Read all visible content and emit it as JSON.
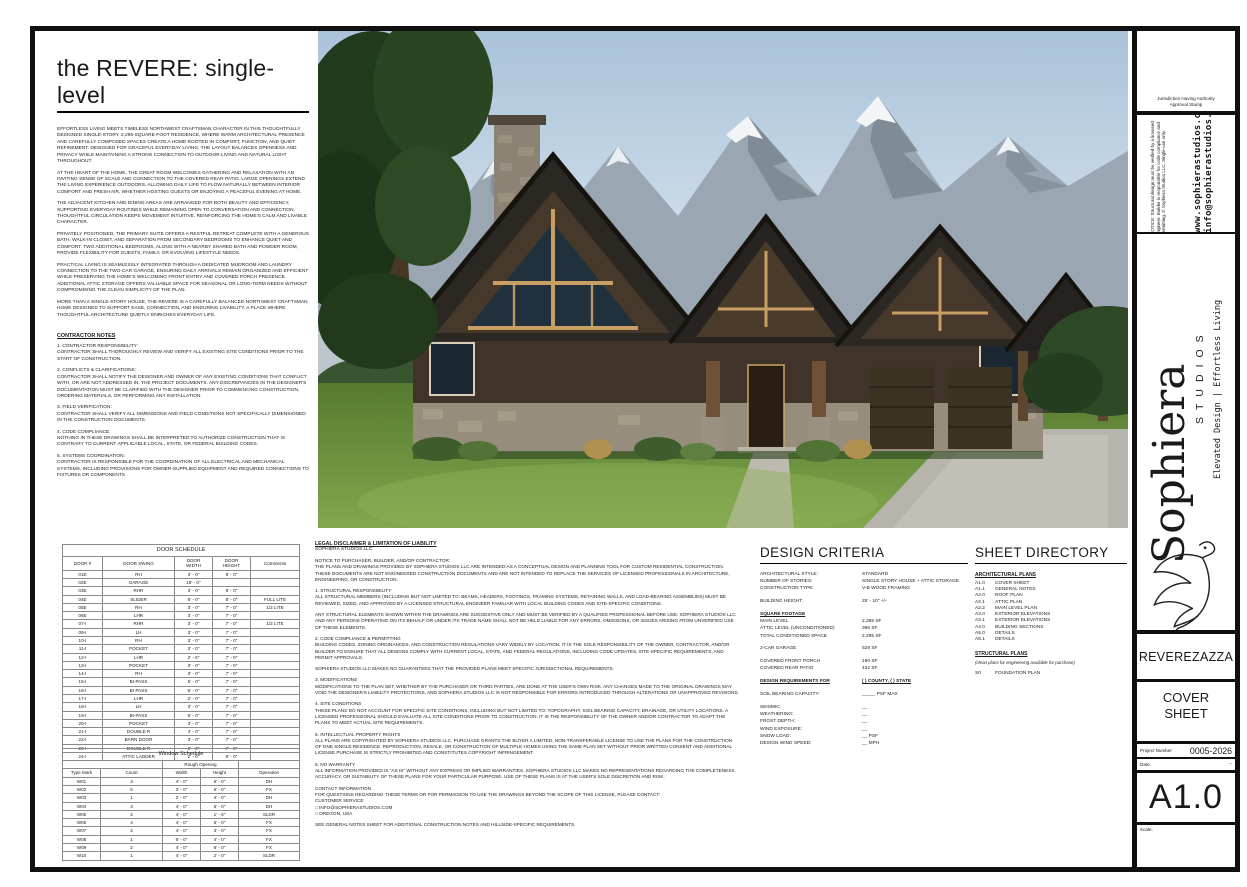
{
  "sheet": {
    "title": "the REVERE: single-level",
    "intro_paragraphs": [
      "EFFORTLESS LIVING MEETS TIMELESS NORTHWEST CRAFTSMAN CHARACTER IN THIS THOUGHTFULLY DESIGNED SINGLE-STORY, 2,295-SQUARE-FOOT RESIDENCE, WHERE WARM ARCHITECTURAL PRESENCE AND CAREFULLY COMPOSED SPACES CREATE A HOME ROOTED IN COMFORT, FUNCTION, AND QUIET REFINEMENT. DESIGNED FOR GRACEFUL EVERYDAY LIVING, THE LAYOUT BALANCES OPENNESS AND PRIVACY WHILE MAINTAINING A STRONG CONNECTION TO OUTDOOR LIVING AND NATURAL LIGHT THROUGHOUT.",
      "AT THE HEART OF THE HOME, THE GREAT ROOM WELCOMES GATHERING AND RELAXATION WITH AN INVITING SENSE OF SCALE AND CONNECTION TO THE COVERED REAR PATIO. LARGE OPENINGS EXTEND THE LIVING EXPERIENCE OUTDOORS, ALLOWING DAILY LIFE TO FLOW NATURALLY BETWEEN INTERIOR COMFORT AND FRESH AIR, WHETHER HOSTING GUESTS OR ENJOYING A PEACEFUL EVENING AT HOME.",
      "THE ADJACENT KITCHEN AND DINING AREAS ARE ARRANGED FOR BOTH BEAUTY AND EFFICIENCY, SUPPORTING EVERYDAY ROUTINES WHILE REMAINING OPEN TO CONVERSATION AND CONNECTION. THOUGHTFUL CIRCULATION KEEPS MOVEMENT INTUITIVE, REINFORCING THE HOME'S CALM AND LIVABLE CHARACTER.",
      "PRIVATELY POSITIONED, THE PRIMARY SUITE OFFERS A RESTFUL RETREAT COMPLETE WITH A GENEROUS BATH, WALK-IN CLOSET, AND SEPARATION FROM SECONDARY BEDROOMS TO ENHANCE QUIET AND COMFORT. TWO ADDITIONAL BEDROOMS, ALONG WITH A NEARBY SHARED BATH AND POWDER ROOM, PROVIDE FLEXIBILITY FOR GUESTS, FAMILY, OR EVOLVING LIFESTYLE NEEDS.",
      "PRACTICAL LIVING IS SEAMLESSLY INTEGRATED THROUGH A DEDICATED MUDROOM AND LAUNDRY CONNECTION TO THE TWO-CAR GARAGE, ENSURING DAILY ARRIVALS REMAIN ORGANIZED AND EFFICIENT WHILE PRESERVING THE HOME'S WELCOMING FRONT ENTRY AND COVERED PORCH PRESENCE. ADDITIONAL ATTIC STORAGE OFFERS VALUABLE SPACE FOR SEASONAL OR LONG-TERM NEEDS WITHOUT COMPROMISING THE CLEAN SIMPLICITY OF THE PLAN.",
      "MORE THAN A SINGLE-STORY HOUSE, THE REVERE IS A CAREFULLY BALANCED NORTHWEST CRAFTSMAN HOME DESIGNED TO SUPPORT EASE, CONNECTION, AND ENDURING LIVABILITY, A PLACE WHERE THOUGHTFUL ARCHITECTURE QUIETLY ENRICHES EVERYDAY LIFE."
    ],
    "contractor_notes": {
      "heading": "CONTRACTOR NOTES",
      "items": [
        "1. CONTRACTOR RESPONSIBILITY:\n CONTRACTOR SHALL THOROUGHLY REVIEW AND VERIFY ALL EXISTING SITE CONDITIONS PRIOR TO THE START OF CONSTRUCTION.",
        "2. CONFLICTS & CLARIFICATIONS:\n CONTRACTOR SHALL NOTIFY THE DESIGNER AND OWNER OF ANY EXISTING CONDITIONS THAT CONFLICT WITH, OR ARE NOT ADDRESSED IN, THE PROJECT DOCUMENTS. ANY DISCREPANCIES IN THE DESIGNER'S DOCUMENTATION MUST BE CLARIFIED WITH THE DESIGNER PRIOR TO COMMENCING CONSTRUCTION, ORDERING MATERIALS, OR PERFORMING ANY INSTALLATION.",
        "3. FIELD VERIFICATION:\n CONTRACTOR SHALL VERIFY ALL DIMENSIONS AND FIELD CONDITIONS NOT SPECIFICALLY DIMENSIONED IN THE CONSTRUCTION DOCUMENTS.",
        "4. CODE COMPLIANCE:\n NOTHING IN THESE DRAWINGS SHALL BE INTERPRETED TO AUTHORIZE CONSTRUCTION THAT IS CONTRARY TO CURRENT APPLICABLE LOCAL, STATE, OR FEDERAL BUILDING CODES.",
        "5. SYSTEMS COORDINATION:\n CONTRACTOR IS RESPONSIBLE FOR THE COORDINATION OF ALL ELECTRICAL AND MECHANICAL SYSTEMS, INCLUDING PROVISIONS FOR OWNER-SUPPLIED EQUIPMENT AND REQUIRED CONNECTIONS TO FIXTURES OR COMPONENTS."
      ]
    }
  },
  "door_schedule": {
    "title": "DOOR SCHEDULE",
    "columns": [
      "DOOR #",
      "DOOR SWING",
      "DOOR\nWIDTH",
      "DOOR\nHEIGHT",
      "Comments"
    ],
    "rows": [
      [
        "01E",
        "RH",
        "3' - 0\"",
        "8' - 0\"",
        ""
      ],
      [
        "02E",
        "GARAGE",
        "18' - 0\"",
        "",
        ""
      ],
      [
        "03E",
        "RHR",
        "3' - 0\"",
        "8' - 0\"",
        ""
      ],
      [
        "04E",
        "SLIDER",
        "8' - 0\"",
        "8' - 0\"",
        "FULL LITE"
      ],
      [
        "05E",
        "RH",
        "3' - 0\"",
        "7' - 0\"",
        "1/2 LITE"
      ],
      [
        "06E",
        "LHR",
        "3' - 0\"",
        "7' - 0\"",
        ""
      ],
      [
        "07-I",
        "RHR",
        "3' - 0\"",
        "7' - 0\"",
        "1/2 LITE"
      ],
      [
        "09-I",
        "LH",
        "3' - 0\"",
        "7' - 0\"",
        ""
      ],
      [
        "10-I",
        "RH",
        "3' - 0\"",
        "7' - 0\"",
        ""
      ],
      [
        "11-I",
        "POCKET",
        "3' - 0\"",
        "7' - 0\"",
        ""
      ],
      [
        "12-I",
        "LHR",
        "2' - 6\"",
        "7' - 0\"",
        ""
      ],
      [
        "13-I",
        "POCKET",
        "3' - 0\"",
        "7' - 0\"",
        ""
      ],
      [
        "14-I",
        "RH",
        "3' - 0\"",
        "7' - 0\"",
        ""
      ],
      [
        "15-I",
        "BI-PASS",
        "5' - 0\"",
        "7' - 0\"",
        ""
      ],
      [
        "16-I",
        "BI-PASS",
        "6' - 0\"",
        "7' - 0\"",
        ""
      ],
      [
        "17-I",
        "LHR",
        "2' - 0\"",
        "7' - 0\"",
        ""
      ],
      [
        "18-I",
        "LH",
        "3' - 0\"",
        "7' - 0\"",
        ""
      ],
      [
        "19-I",
        "BI-PASS",
        "5' - 0\"",
        "7' - 0\"",
        ""
      ],
      [
        "20-I",
        "POCKET",
        "3' - 0\"",
        "7' - 0\"",
        ""
      ],
      [
        "21-I",
        "DOUBLE R",
        "4' - 0\"",
        "7' - 0\"",
        ""
      ],
      [
        "22-I",
        "BARN DOOR",
        "3' - 0\"",
        "7' - 0\"",
        ""
      ],
      [
        "23-I",
        "DOUBLE R",
        "5' - 0\"",
        "7' - 0\"",
        ""
      ],
      [
        "24-I",
        "ATTIC LADDER",
        "2' - 0\"",
        "9' - 0\"",
        ""
      ]
    ]
  },
  "window_schedule": {
    "title": "Window Schedule",
    "group_header": "Rough Opening",
    "columns": [
      "Type Mark",
      "Count",
      "Width",
      "Height",
      "Operation"
    ],
    "rows": [
      [
        "W01",
        "3",
        "4' - 0\"",
        "5' - 0\"",
        "DH"
      ],
      [
        "W02",
        "5",
        "3' - 0\"",
        "5' - 0\"",
        "FX"
      ],
      [
        "W03",
        "1",
        "2' - 0\"",
        "4' - 0\"",
        "DH"
      ],
      [
        "W04",
        "3",
        "4' - 0\"",
        "6' - 0\"",
        "DH"
      ],
      [
        "W05",
        "2",
        "4' - 0\"",
        "1' - 6\"",
        "SLDR"
      ],
      [
        "W06",
        "4",
        "4' - 0\"",
        "6' - 0\"",
        "FX"
      ],
      [
        "W07",
        "2",
        "4' - 0\"",
        "3' - 0\"",
        "FX"
      ],
      [
        "W08",
        "1",
        "6' - 0\"",
        "4' - 0\"",
        "FX"
      ],
      [
        "W09",
        "2",
        "4' - 0\"",
        "6' - 0\"",
        "FX"
      ],
      [
        "W10",
        "1",
        "4' - 0\"",
        "2' - 0\"",
        "SLDR"
      ]
    ]
  },
  "legal": {
    "heading": "LEGAL DISCLAIMER & LIMITATION OF LIABILITY",
    "subheading": "SOPHIERA STUDIOS LLC",
    "paragraphs": [
      "NOTICE TO PURCHASER, BUILDER, AND/OR CONTRACTOR:\nTHE PLANS AND DRAWINGS PROVIDED BY SOPHIERA STUDIOS LLC ARE INTENDED AS A CONCEPTUAL DESIGN AND PLANNING TOOL FOR CUSTOM RESIDENTIAL CONSTRUCTION. THESE DOCUMENTS ARE NOT ENGINEERED CONSTRUCTION DOCUMENTS AND ARE NOT INTENDED TO REPLACE THE SERVICES OF LICENSED PROFESSIONALS IN ARCHITECTURE, ENGINEERING, OR CONSTRUCTION.",
      "1. STRUCTURAL RESPONSIBILITY\nALL STRUCTURAL MEMBERS (INCLUDING BUT NOT LIMITED TO: BEAMS, HEADERS, FOOTINGS, FRAMING SYSTEMS, RETAINING WALLS, AND LOAD-BEARING ASSEMBLIES) MUST BE REVIEWED, SIZED, AND APPROVED BY A LICENSED STRUCTURAL ENGINEER FAMILIAR WITH LOCAL BUILDING CODES AND SITE-SPECIFIC CONDITIONS.",
      "ANY STRUCTURAL ELEMENTS SHOWN WITHIN THE DRAWINGS ARE SUGGESTIVE ONLY AND MUST BE VERIFIED BY A QUALIFIED PROFESSIONAL BEFORE USE. SOPHIERA STUDIOS LLC AND ANY PERSONS OPERATING ON ITS BEHALF OR UNDER ITS TRADE NAME SHALL NOT BE HELD LIABLE FOR ANY ERRORS, OMISSIONS, OR ISSUES ARISING FROM UNVERIFIED USE OF THESE ELEMENTS.",
      "2. CODE COMPLIANCE & PERMITTING\nBUILDING CODES, ZONING ORDINANCES, AND CONSTRUCTION REGULATIONS VARY WIDELY BY LOCATION. IT IS THE SOLE RESPONSIBILITY OF THE OWNER, CONTRACTOR, AND/OR BUILDER TO ENSURE THAT ALL DESIGNS COMPLY WITH CURRENT LOCAL, STATE, AND FEDERAL REGULATIONS, INCLUDING CODE UPDATES, SITE-SPECIFIC REQUIREMENTS, AND PERMIT APPROVALS.",
      "SOPHIERA STUDIOS LLC MAKES NO GUARANTEES THAT THE PROVIDED PLANS MEET SPECIFIC JURISDICTIONAL REQUIREMENTS.",
      "3. MODIFICATIONS\nMODIFICATIONS TO THE PLAN SET, WHETHER BY THE PURCHASER OR THIRD PARTIES, ARE DONE AT THE USER'S OWN RISK. ANY CHANGES MADE TO THE ORIGINAL DRAWINGS MAY VOID THE DESIGNER'S LIABILITY PROTECTIONS, AND SOPHIERA STUDIOS LLC IS NOT RESPONSIBLE FOR ERRORS INTRODUCED THROUGH ALTERATIONS OR UNAPPROVED REVISIONS.",
      "4. SITE CONDITIONS\nTHESE PLANS DO NOT ACCOUNT FOR SPECIFIC SITE CONDITIONS, INCLUDING BUT NOT LIMITED TO: TOPOGRAPHY, SOIL BEARING CAPACITY, DRAINAGE, OR UTILITY LOCATIONS. A LICENSED PROFESSIONAL SHOULD EVALUATE ALL SITE CONDITIONS PRIOR TO CONSTRUCTION. IT IS THE RESPONSIBILITY OF THE OWNER AND/OR CONTRACTOR TO ADAPT THE PLANS TO MEET ACTUAL SITE REQUIREMENTS.",
      "5. INTELLECTUAL PROPERTY RIGHTS\nALL PLANS ARE COPYRIGHTED BY SOPHIERA STUDIOS LLC. PURCHASE GRANTS THE BUYER A LIMITED, NON-TRANSFERABLE LICENSE TO USE THE PLANS FOR THE CONSTRUCTION OF ONE SINGLE RESIDENCE. REPRODUCTION, RESALE, OR CONSTRUCTION OF MULTIPLE HOMES USING THE SAME PLAN SET WITHOUT PRIOR WRITTEN CONSENT AND ADDITIONAL LICENSE PURCHASE IS STRICTLY PROHIBITED AND CONSTITUTES COPYRIGHT INFRINGEMENT.",
      "6. NO WARRANTY\nALL INFORMATION PROVIDED IS \"AS IS\" WITHOUT ANY EXPRESS OR IMPLIED WARRANTIES. SOPHIERA STUDIOS LLC MAKES NO REPRESENTATIONS REGARDING THE COMPLETENESS, ACCURACY, OR SUITABILITY OF THESE PLANS FOR YOUR PARTICULAR PURPOSE. USE OF THESE PLANS IS AT THE USER'S SOLE DISCRETION AND RISK.",
      "CONTACT INFORMATION\nFOR QUESTIONS REGARDING THESE TERMS OR FOR PERMISSION TO USE THE DRAWINGS BEYOND THE SCOPE OF THIS LICENSE, PLEASE CONTACT:\nCUSTOMER SERVICE\n□ INFO@SOPHIERASTUDIOS.COM\n□ OREGON, USA",
      "SEE GENERAL NOTES SHEET FOR ADDITIONAL CONSTRUCTION NOTES AND HILLSIDE-SPECIFIC REQUIREMENTS."
    ]
  },
  "design_criteria": {
    "title": "DESIGN CRITERIA",
    "rows": [
      {
        "label": "ARCHITECTURAL STYLE:",
        "value": "STANDARD",
        "style": ""
      },
      {
        "label": "NUMBER OF STORIES:",
        "value": "SINGLE STORY HOUSE + ATTIC STORAGE",
        "style": ""
      },
      {
        "label": "CONSTRUCTION TYPE:",
        "value": "V-B WOOD FRAMING",
        "style": ""
      },
      {
        "label": "",
        "value": "",
        "style": "gap"
      },
      {
        "label": "BUILDING HEIGHT:",
        "value": "25' - 10\" +/-",
        "style": ""
      },
      {
        "label": "",
        "value": "",
        "style": "gap"
      },
      {
        "label": "SQUARE FOOTAGE",
        "value": "",
        "style": "head"
      },
      {
        "label": "MAIN LEVEL",
        "value": "2,295 SF",
        "style": ""
      },
      {
        "label": "ATTIC LEVEL (UNCONDITIONED)",
        "value": "395 SF",
        "style": ""
      },
      {
        "label": "TOTAL CONDITIONED SPACE",
        "value": "2,295 SF",
        "style": ""
      },
      {
        "label": "",
        "value": "",
        "style": "gap"
      },
      {
        "label": "2-CAR GARAGE",
        "value": "528 SF",
        "style": ""
      },
      {
        "label": "",
        "value": "",
        "style": "gap"
      },
      {
        "label": "COVERED FRONT PORCH",
        "value": "190 SF",
        "style": ""
      },
      {
        "label": "COVERED REAR PATIO",
        "value": "432 SF",
        "style": ""
      },
      {
        "label": "",
        "value": "",
        "style": "gap"
      },
      {
        "label": "DESIGN REQUIREMENTS FOR",
        "value": "(   ) COUNTY, (   ) STATE",
        "style": "head"
      },
      {
        "label": "",
        "value": "",
        "style": "gap"
      },
      {
        "label": "SOIL BEARING CAPACITY:",
        "value": "_____ PSF MAX",
        "style": ""
      },
      {
        "label": "",
        "value": "",
        "style": "gap"
      },
      {
        "label": "SEISMIC:",
        "value": "__",
        "style": ""
      },
      {
        "label": "WEATHERING:",
        "value": "__",
        "style": ""
      },
      {
        "label": "FROST DEPTH:",
        "value": "__",
        "style": ""
      },
      {
        "label": "WIND EXPOSURE:",
        "value": "__",
        "style": ""
      },
      {
        "label": "SNOW LOAD:",
        "value": "__ PSF",
        "style": ""
      },
      {
        "label": "DESIGN WIND SPEED:",
        "value": "__ MPH",
        "style": ""
      }
    ]
  },
  "sheet_directory": {
    "title": "SHEET DIRECTORY",
    "arch_heading": "ARCHITECTURAL PLANS",
    "arch_items": [
      {
        "code": "A1.0",
        "label": "COVER SHEET"
      },
      {
        "code": "A1.1",
        "label": "GENERAL NOTES"
      },
      {
        "code": "A2.0",
        "label": "ROOF PLAN"
      },
      {
        "code": "A2.1",
        "label": "ATTIC PLAN"
      },
      {
        "code": "A2.2",
        "label": "MAIN LEVEL PLAN"
      },
      {
        "code": "A3.0",
        "label": "EXTERIOR ELEVATIONS"
      },
      {
        "code": "A3.1",
        "label": "EXTERIOR ELEVATIONS"
      },
      {
        "code": "A4.0",
        "label": "BUILDING SECTIONS"
      },
      {
        "code": "A5.0",
        "label": "DETAILS"
      },
      {
        "code": "A5.1",
        "label": "DETAILS"
      }
    ],
    "struct_heading": "STRUCTURAL PLANS",
    "struct_note": "(clean plans for engineering available for purchase)",
    "struct_items": [
      {
        "code": "S0",
        "label": "FOUNDATION PLAN"
      }
    ]
  },
  "title_block": {
    "stamp_label": "Jurisdiction Having Authority\nApproval Stamp",
    "notice": "NOTICE: Structural design must be verified by a licensed engineer. Builder is responsible for code compliance and permitting. © Sophiera Studios LLC. Single-use only.",
    "website": "www.sophierastudios.com",
    "email": "info@sophierastudios.com",
    "brand_name": "Sophiera",
    "brand_sub": "STUDIOS",
    "brand_tagline": "Elevated Design | Effortless Living",
    "project_name": "REVEREZAZZA",
    "sheet_title": "COVER\nSHEET",
    "project_number_label": "Project Number",
    "project_number": "0005-2026",
    "date_label": "Date:",
    "date_value": "--",
    "sheet_number": "A1.0",
    "scale_label": "Scale:"
  }
}
